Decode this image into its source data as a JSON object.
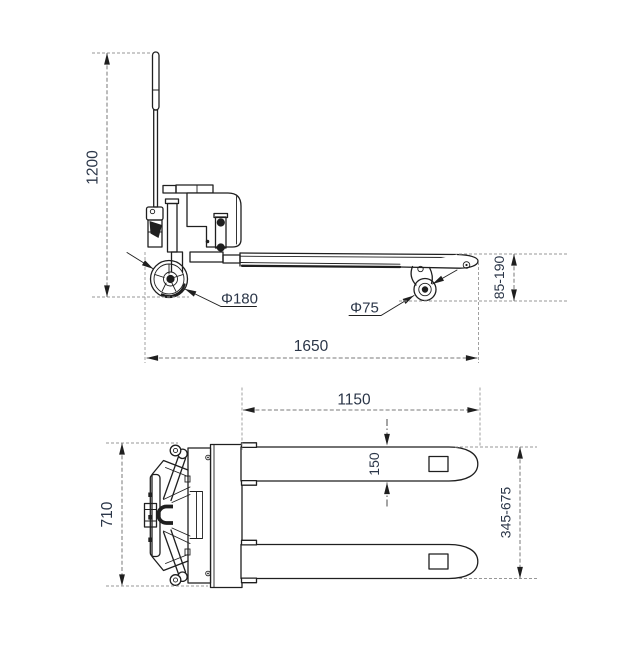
{
  "drawing": {
    "labels": {
      "side": {
        "overall_height": "1200",
        "overall_length": "1650",
        "steer_wheel_dia": "Φ180",
        "load_roller_dia": "Φ75",
        "fork_height_range": "85-190"
      },
      "plan": {
        "overall_width": "710",
        "fork_length": "1150",
        "fork_width": "150",
        "fork_spread_range": "345-675"
      }
    },
    "colors": {
      "line_color": "#1f1f1f",
      "dim_text_color": "#2b3648",
      "ext_line_color": "#979797",
      "dim_line_color": "#7a7a7a",
      "background": "#ffffff"
    }
  }
}
